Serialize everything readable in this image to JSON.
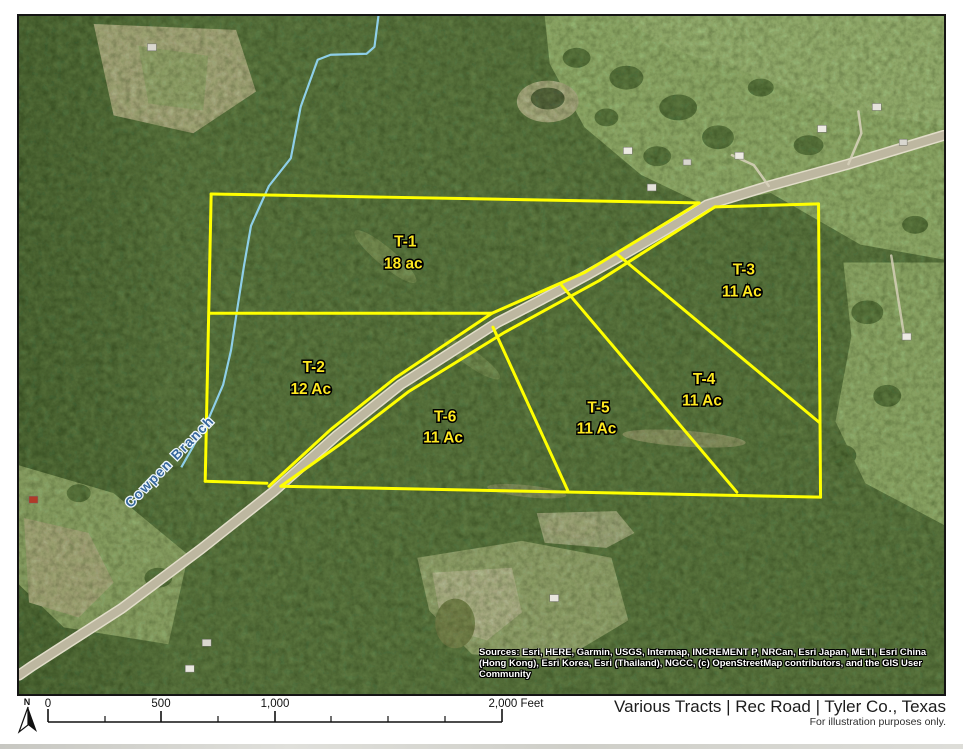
{
  "map": {
    "tracts": [
      {
        "name": "T-1",
        "acreage": "18 ac"
      },
      {
        "name": "T-2",
        "acreage": "12 Ac"
      },
      {
        "name": "T-3",
        "acreage": "11 Ac"
      },
      {
        "name": "T-4",
        "acreage": "11 Ac"
      },
      {
        "name": "T-5",
        "acreage": "11 Ac"
      },
      {
        "name": "T-6",
        "acreage": "11 Ac"
      }
    ],
    "stream_label": "Cowpen Branch",
    "road_name": "Rec Road",
    "boundary_color": "#ffff00",
    "label_color": "#ffe920",
    "attribution": "Sources: Esri, HERE, Garmin, USGS, Intermap, INCREMENT P, NRCan, Esri Japan, METI, Esri China (Hong Kong), Esri Korea, Esri (Thailand), NGCC, (c) OpenStreetMap contributors, and the GIS User Community"
  },
  "footer": {
    "north_label": "N",
    "scale": {
      "ticks": [
        "0",
        "500",
        "1,000"
      ],
      "end_label": "2,000 Feet"
    },
    "title": "Various Tracts | Rec Road | Tyler Co., Texas",
    "disclaimer": "For illustration purposes only."
  }
}
